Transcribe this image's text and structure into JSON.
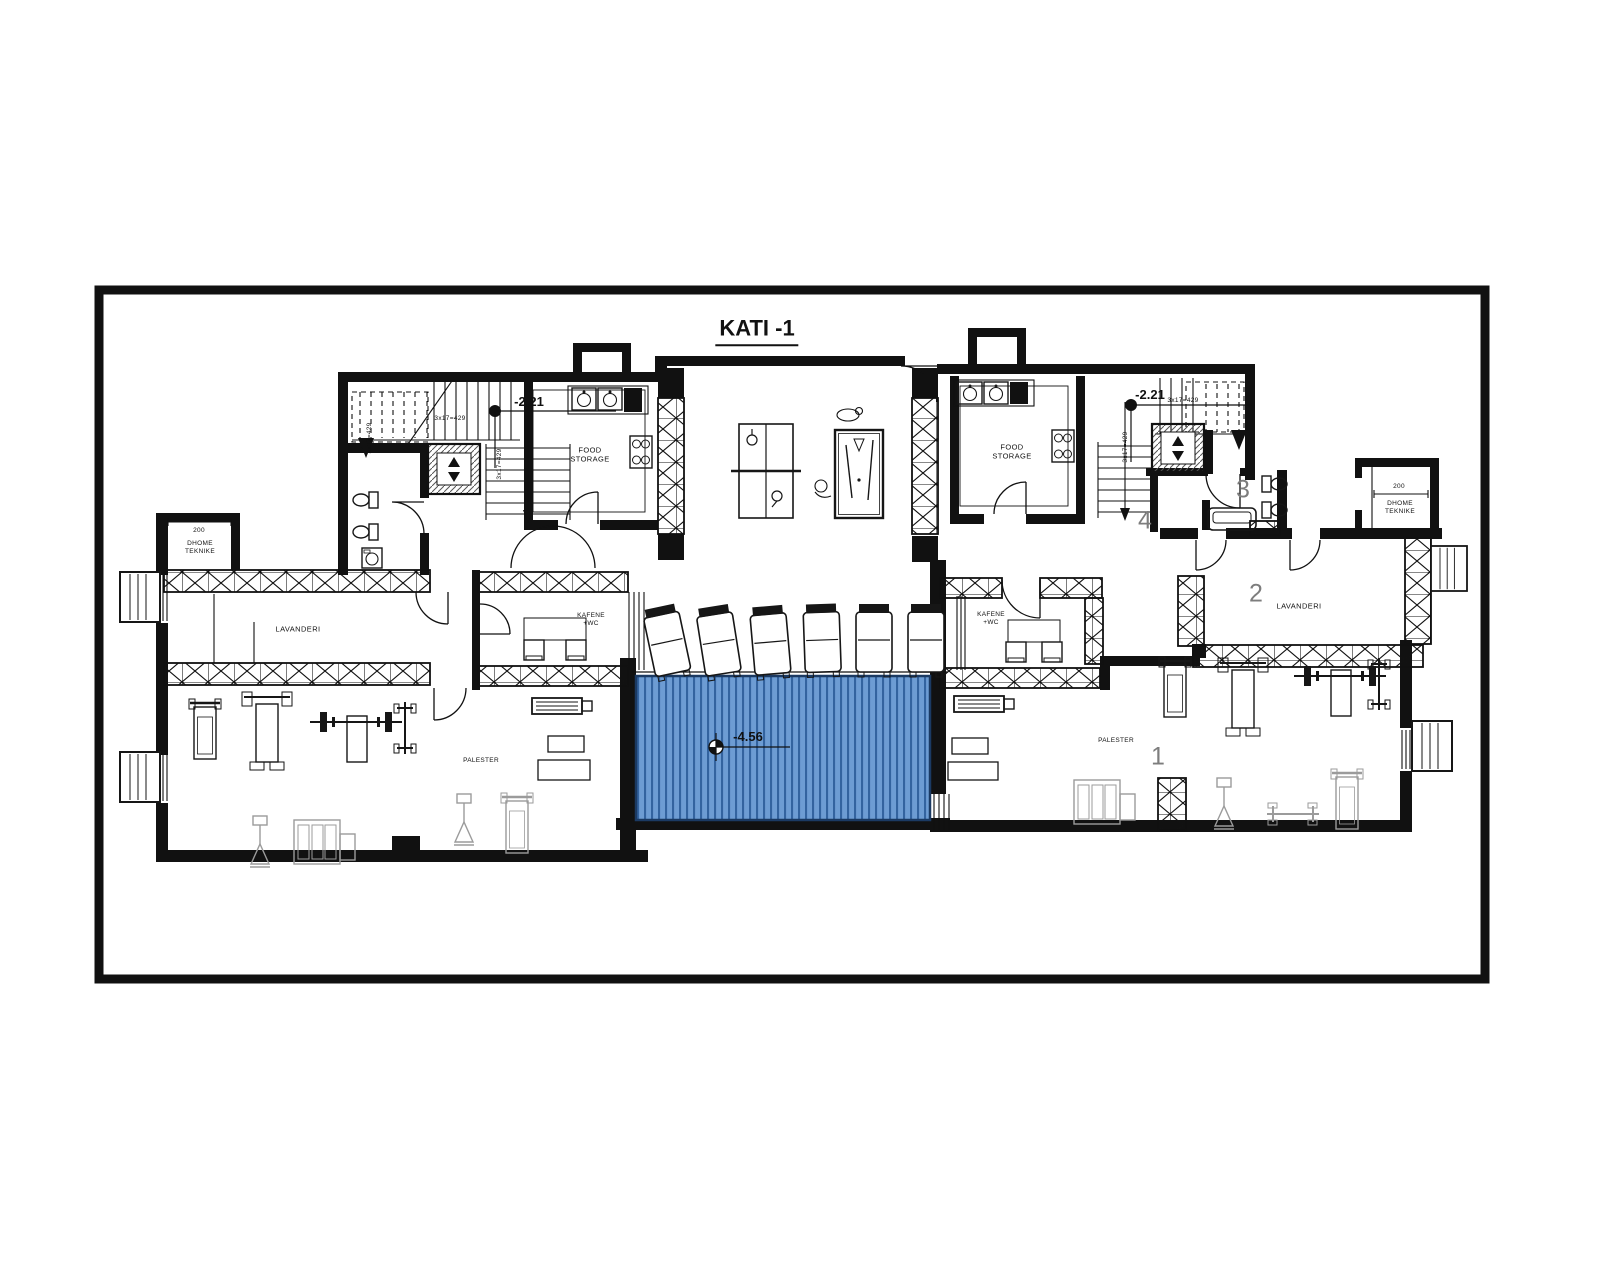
{
  "title": "KATI -1",
  "elevations": {
    "left": "-2.21",
    "right": "-2.21",
    "pool": "-4.56"
  },
  "dimensions": {
    "stair_run": "3x17=429",
    "dhome_width": "200"
  },
  "rooms": {
    "food_storage": {
      "line1": "FOOD",
      "line2": "STORAGE"
    },
    "lavanderi": "LAVANDERI",
    "dhome_teknike": {
      "line1": "DHOME",
      "line2": "TEKNIKE"
    },
    "kafene": {
      "line1": "KAFENE",
      "line2": "+WC"
    },
    "palester": "PALESTER"
  },
  "room_numbers": {
    "palester_right": "1",
    "lavanderi_right": "2",
    "wc_right": "3",
    "hall_right": "4"
  },
  "colors": {
    "pool_fill": "#6d9cd3",
    "pool_stripe": "#33639f",
    "wall": "#111111",
    "room_number": "#7d7d7d",
    "equipment_gray": "#9b9b9b"
  }
}
